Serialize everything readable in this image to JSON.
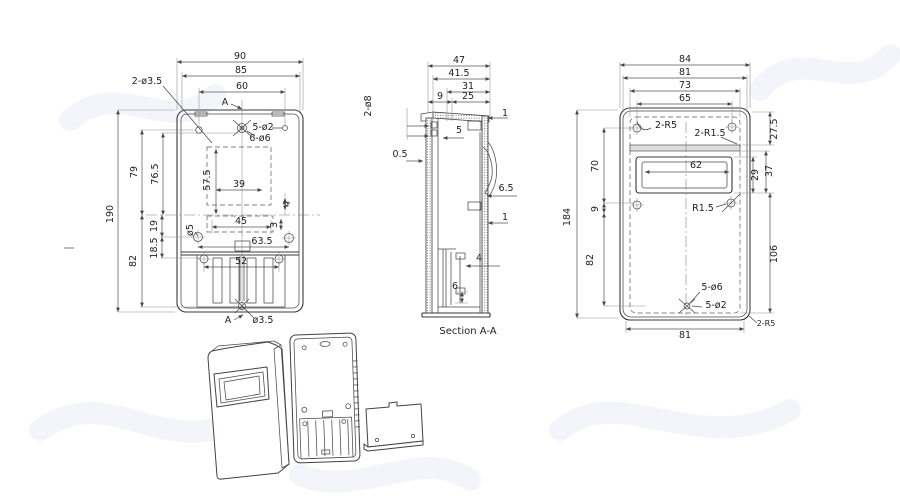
{
  "style": {
    "background": "#ffffff",
    "line_color": "#3a3a3a",
    "dim_text_color": "#222222",
    "watermark_color": "#f3f5fa"
  },
  "views": {
    "front": {
      "dims": [
        {
          "name": "dim-90",
          "text": "90",
          "x": 240,
          "y": 59
        },
        {
          "name": "dim-85",
          "text": "85",
          "x": 241,
          "y": 73
        },
        {
          "name": "dim-60",
          "text": "60",
          "x": 242,
          "y": 89
        },
        {
          "name": "dim-2x-d3-5",
          "text": "2-ø3.5",
          "x": 147,
          "y": 84
        },
        {
          "name": "section-marker-a-top",
          "text": "A",
          "x": 225,
          "y": 105
        },
        {
          "name": "dim-5x-d2",
          "text": "5-ø2",
          "x": 263,
          "y": 130
        },
        {
          "name": "dim-6x-d6",
          "text": "6-ø6",
          "x": 260,
          "y": 141
        },
        {
          "name": "dim-39",
          "text": "39",
          "x": 239,
          "y": 187
        },
        {
          "name": "dim-57-5",
          "text": "57.5",
          "x": 210,
          "y": 180,
          "rot": -90
        },
        {
          "name": "dim-79",
          "text": "79",
          "x": 137,
          "y": 172,
          "rot": -90
        },
        {
          "name": "dim-76-5",
          "text": "76.5",
          "x": 158,
          "y": 174,
          "rot": -90
        },
        {
          "name": "dim-190",
          "text": "190",
          "x": 113,
          "y": 214,
          "rot": -90
        },
        {
          "name": "dim-19",
          "text": "19",
          "x": 157,
          "y": 226,
          "rot": -90
        },
        {
          "name": "dim-18-5",
          "text": "18.5",
          "x": 157,
          "y": 248,
          "rot": -90
        },
        {
          "name": "dim-82",
          "text": "82",
          "x": 136,
          "y": 261,
          "rot": -90
        },
        {
          "name": "dim-d5",
          "text": "ø5",
          "x": 193,
          "y": 230,
          "rot": -90
        },
        {
          "name": "dim-45",
          "text": "45",
          "x": 241,
          "y": 224
        },
        {
          "name": "dim-3",
          "text": "3",
          "x": 277,
          "y": 225,
          "rot": -90
        },
        {
          "name": "dim-4",
          "text": "4",
          "x": 290,
          "y": 204,
          "rot": -90
        },
        {
          "name": "dim-63-5",
          "text": "63.5",
          "x": 262,
          "y": 244
        },
        {
          "name": "dim-52",
          "text": "52",
          "x": 241,
          "y": 264
        },
        {
          "name": "dim-d3-5",
          "text": "ø3.5",
          "x": 263,
          "y": 323
        },
        {
          "name": "section-marker-a-bottom",
          "text": "A",
          "x": 228,
          "y": 323
        }
      ]
    },
    "section": {
      "caption": "Section A-A",
      "dims": [
        {
          "name": "dim-47",
          "text": "47",
          "x": 459,
          "y": 63
        },
        {
          "name": "dim-41-5",
          "text": "41.5",
          "x": 459,
          "y": 76
        },
        {
          "name": "dim-31",
          "text": "31",
          "x": 468,
          "y": 89
        },
        {
          "name": "dim-9-top",
          "text": "9",
          "x": 440,
          "y": 99
        },
        {
          "name": "dim-25",
          "text": "25",
          "x": 468,
          "y": 99
        },
        {
          "name": "dim-2x-d8",
          "text": "2-ø8",
          "x": 371,
          "y": 106,
          "rot": -90
        },
        {
          "name": "dim-5",
          "text": "5",
          "x": 459,
          "y": 133
        },
        {
          "name": "dim-1-top",
          "text": "1",
          "x": 505,
          "y": 116
        },
        {
          "name": "dim-0-5",
          "text": "0.5",
          "x": 400,
          "y": 157
        },
        {
          "name": "dim-6-5",
          "text": "6.5",
          "x": 506,
          "y": 191
        },
        {
          "name": "dim-1-bottom",
          "text": "1",
          "x": 505,
          "y": 220
        },
        {
          "name": "dim-4s",
          "text": "4",
          "x": 479,
          "y": 261
        },
        {
          "name": "dim-6s",
          "text": "6",
          "x": 455,
          "y": 289
        }
      ]
    },
    "rear": {
      "dims": [
        {
          "name": "dim-84",
          "text": "84",
          "x": 685,
          "y": 62
        },
        {
          "name": "dim-81-top",
          "text": "81",
          "x": 685,
          "y": 75
        },
        {
          "name": "dim-73",
          "text": "73",
          "x": 685,
          "y": 88
        },
        {
          "name": "dim-65",
          "text": "65",
          "x": 685,
          "y": 101
        },
        {
          "name": "dim-2x-r5-top",
          "text": "2-R5",
          "x": 666,
          "y": 128
        },
        {
          "name": "dim-2x-r1-5",
          "text": "2-R1.5",
          "x": 710,
          "y": 136
        },
        {
          "name": "dim-27-5",
          "text": "27.5",
          "x": 777,
          "y": 129,
          "rot": -90
        },
        {
          "name": "dim-62",
          "text": "62",
          "x": 696,
          "y": 168
        },
        {
          "name": "dim-29",
          "text": "29",
          "x": 758,
          "y": 175,
          "rot": -90
        },
        {
          "name": "dim-37",
          "text": "37",
          "x": 772,
          "y": 171,
          "rot": -90
        },
        {
          "name": "dim-70",
          "text": "70",
          "x": 598,
          "y": 166,
          "rot": -90
        },
        {
          "name": "dim-184",
          "text": "184",
          "x": 570,
          "y": 217,
          "rot": -90
        },
        {
          "name": "dim-9-rear",
          "text": "9",
          "x": 598,
          "y": 209,
          "rot": -90
        },
        {
          "name": "dim-82-rear",
          "text": "82",
          "x": 593,
          "y": 260,
          "rot": -90
        },
        {
          "name": "dim-106",
          "text": "106",
          "x": 777,
          "y": 254,
          "rot": -90
        },
        {
          "name": "dim-r1-5",
          "text": "R1.5",
          "x": 703,
          "y": 211
        },
        {
          "name": "dim-5x-d6",
          "text": "5-ø6",
          "x": 712,
          "y": 290
        },
        {
          "name": "dim-5x-d2-rear",
          "text": "5-ø2",
          "x": 716,
          "y": 308
        },
        {
          "name": "dim-81-bottom",
          "text": "81",
          "x": 685,
          "y": 338
        },
        {
          "name": "dim-2x-r5-bottom",
          "text": "2-R5",
          "x": 766,
          "y": 326,
          "fs": 8
        }
      ]
    }
  }
}
